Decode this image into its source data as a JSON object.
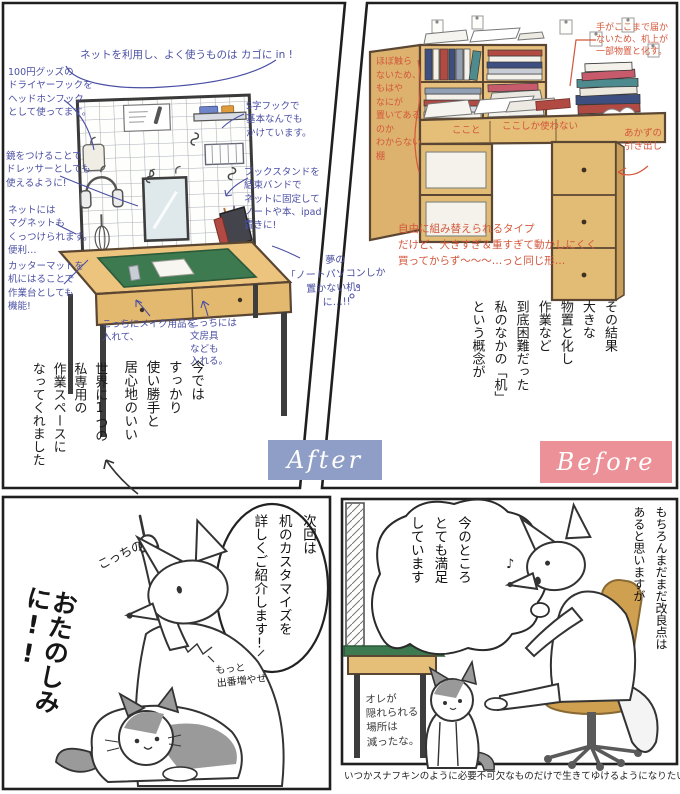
{
  "after": {
    "label": "After",
    "net_note": "ネットを利用し、よく使うものは カゴに in !",
    "dryer_note": "100円グッズの\nドライヤーフックを\nヘッドホンフック\nとして使ってます。",
    "mirror_note": "鏡をつけることで\nドレッサーとしても\n使えるように!",
    "magnet_note": "ネットには\nマグネットも\nくっつけられます。\n便利…",
    "cutter_note": "カッターマットを\n机にはることで\n作業台としても\n機能!",
    "shook_note": "S字フックで\n基本なんでも\nかけています。",
    "bookstand_note": "ブックスタンドを\n結束バンドで\nネットに固定して\nノートや本、ipad\n置きに!",
    "makeup_note": "こっちにメイク用品を\n入れて、",
    "stationery_note": "こっちには\n文房具\nなども\n入れる。",
    "dream_note": "夢の\n「ノートパソコンしか\n置かない机」\nに…!!",
    "result_text_1": "今では\nすっかり\n使い勝手と\n居心地のいい",
    "result_text_2": "世界に1つの\n私専用の\n作業スペースに\nなってくれました"
  },
  "before": {
    "label": "Before",
    "reach_note": "手がここまで届か\nないため、机上が\n一部物置と化す。",
    "shelf_note": "ほぼ触ら\nないため、\nもはや\nなにが\n置いてある\nのか\nわからない\n棚",
    "here_note": "ここと",
    "here_only_note": "ここしか使わない",
    "drawer_note": "あかずの\n引き出し",
    "type_note": "自由に組み替えられるタイプ\nだけど、大きすぎ＆重すぎて動かしにくく\n買ってからず〜〜〜…っと同じ形…",
    "result_text": "その結果\n大きな\n物置と化し\n作業など\n到底困難だった\n私のなかの「机」\nという概念が"
  },
  "teaser": {
    "pointing_note": "こっちの",
    "speech_bubble": "次回は\n机のカスタマイズを\n詳しくご紹介します!",
    "cat_aside": "もっと\n出番増やせ",
    "big_text": "おたのしみに!!"
  },
  "satisfied": {
    "speech_bubble": "今のところ\nとても満足\nしています",
    "side_note": "もちろんまだまだ改良点は\nあると思いますが",
    "cat_thought": "オレが\n隠れられる\n場所は\n減ったな。",
    "music_note": "♪"
  },
  "caption": "いつかスナフキンのように必要不可欠なものだけで生きてゆけるようになりたい…",
  "colors": {
    "blue_ink": "#4a4fa3",
    "red_ink": "#d4573b",
    "after_badge": "#8e9ec6",
    "before_badge": "#eb9197",
    "wood": "#e6c07c",
    "mat_green": "#3e7a4f",
    "chair": "#cfa04f"
  }
}
